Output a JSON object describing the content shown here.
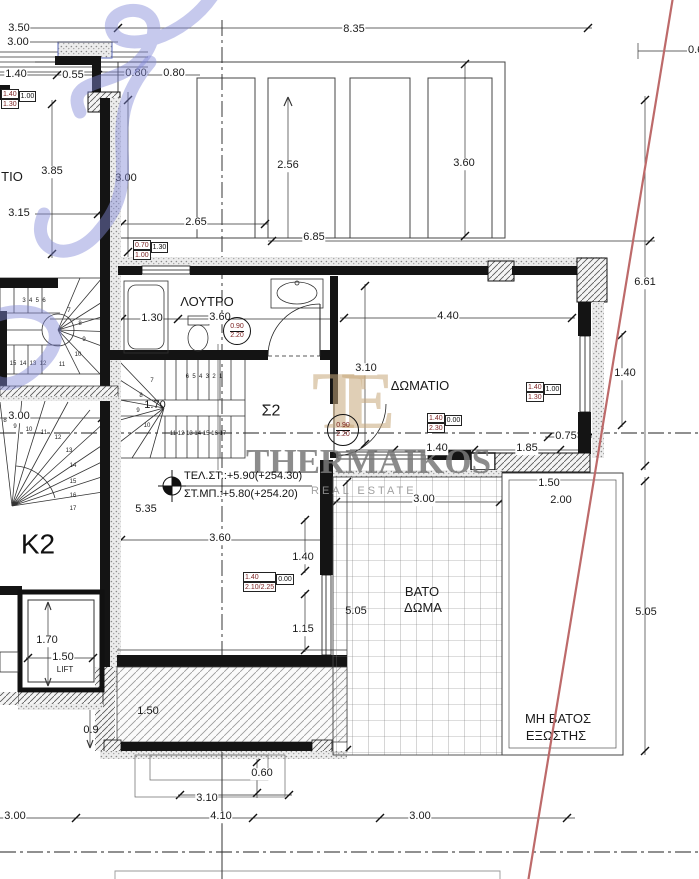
{
  "watermark": {
    "brand": "THERMAIKOS",
    "subtitle": "REAL ESTATE",
    "monogram": "TE"
  },
  "rooms": {
    "bathroom": "ΛΟΥΤΡΟ",
    "bedroom": "ΔΩΜΑΤΙΟ",
    "stair_label": "Σ2",
    "core_label": "K2",
    "lift": "LIFT",
    "roof_terrace_line1": "ΒΑΤΟ",
    "roof_terrace_line2": "ΔΩΜΑ",
    "balcony_line1": "ΜΗ ΒΑΤΟΣ",
    "balcony_line2": "ΕΞΩΣΤΗΣ",
    "adjacent_room_partial": "ΤΙΟ"
  },
  "levels": {
    "top": "ΤΕΛ.ΣΤ.:+5.90(+254.30)",
    "bottom": "ΣΤ.ΜΠ.:+5.80(+254.20)"
  },
  "dims": {
    "top_span": "8.35",
    "left_350": "3.50",
    "left_300": "3.00",
    "left_140": "1.40",
    "left_055": "0.55",
    "top_080a": "0.80",
    "top_080b": "0.80",
    "left_385": "3.85",
    "left_315": "3.15",
    "wall_300": "3.00",
    "roof_256": "2.56",
    "roof_360": "3.60",
    "roof_265": "2.65",
    "roof_685": "6.85",
    "right_06": "0.6",
    "right_661": "6.61",
    "bath_130": "1.30",
    "bath_360": "3.60",
    "bed_440": "4.40",
    "bed_310": "3.10",
    "bed_win_140": "1.40",
    "bed_075": "0.75",
    "bed_140": "1.40",
    "bed_185": "1.85",
    "mid_535": "5.35",
    "low_360": "3.60",
    "low_140": "1.40",
    "low_115": "1.15",
    "terr_505_l": "5.05",
    "terr_300": "3.00",
    "balc_150": "1.50",
    "balc_200": "2.00",
    "terr_505_r": "5.05",
    "lift_170": "1.70",
    "lift_150": "1.50",
    "wall_090": "0.9",
    "balc_150b": "1.50",
    "bot_060": "0.60",
    "bot_310": "3.10",
    "bot_410": "4.10",
    "bot_300_l": "3.00",
    "bot_300_r": "3.00",
    "stair_300": "3.00",
    "stair_170": "1.70"
  },
  "markers": {
    "m1": {
      "top": "1.40",
      "bottom": "1.30",
      "side": "1.00"
    },
    "m2": {
      "top": "0.70",
      "bottom": "1.00",
      "side": "1.30"
    },
    "m3": {
      "top": "1.40",
      "bottom": "1.30",
      "side": "1.00"
    },
    "m4": {
      "top": "1.40",
      "bottom": "2.30",
      "side": "0.00"
    },
    "m5": {
      "top": "1.40",
      "bottom": "2.10/2.25",
      "side": "0.00"
    }
  },
  "door_tags": {
    "bath": {
      "w": "0.90",
      "h": "2.20"
    },
    "bed": {
      "w": "0.90",
      "h": "2.20"
    }
  },
  "stairs": {
    "k2_top": "6  5  4  3  2  1",
    "k2_bottom": "11 12 13 14 15 16 17",
    "k2_winder": [
      "7",
      "8",
      "9",
      "10"
    ],
    "left_top": "3  4  5  6",
    "left_bottom": "15  14  13  12",
    "left_winder": [
      "7",
      "8",
      "9",
      "10",
      "11"
    ],
    "fan": [
      "8",
      "9",
      "10",
      "11",
      "12",
      "13",
      "14",
      "15",
      "16",
      "17"
    ]
  }
}
